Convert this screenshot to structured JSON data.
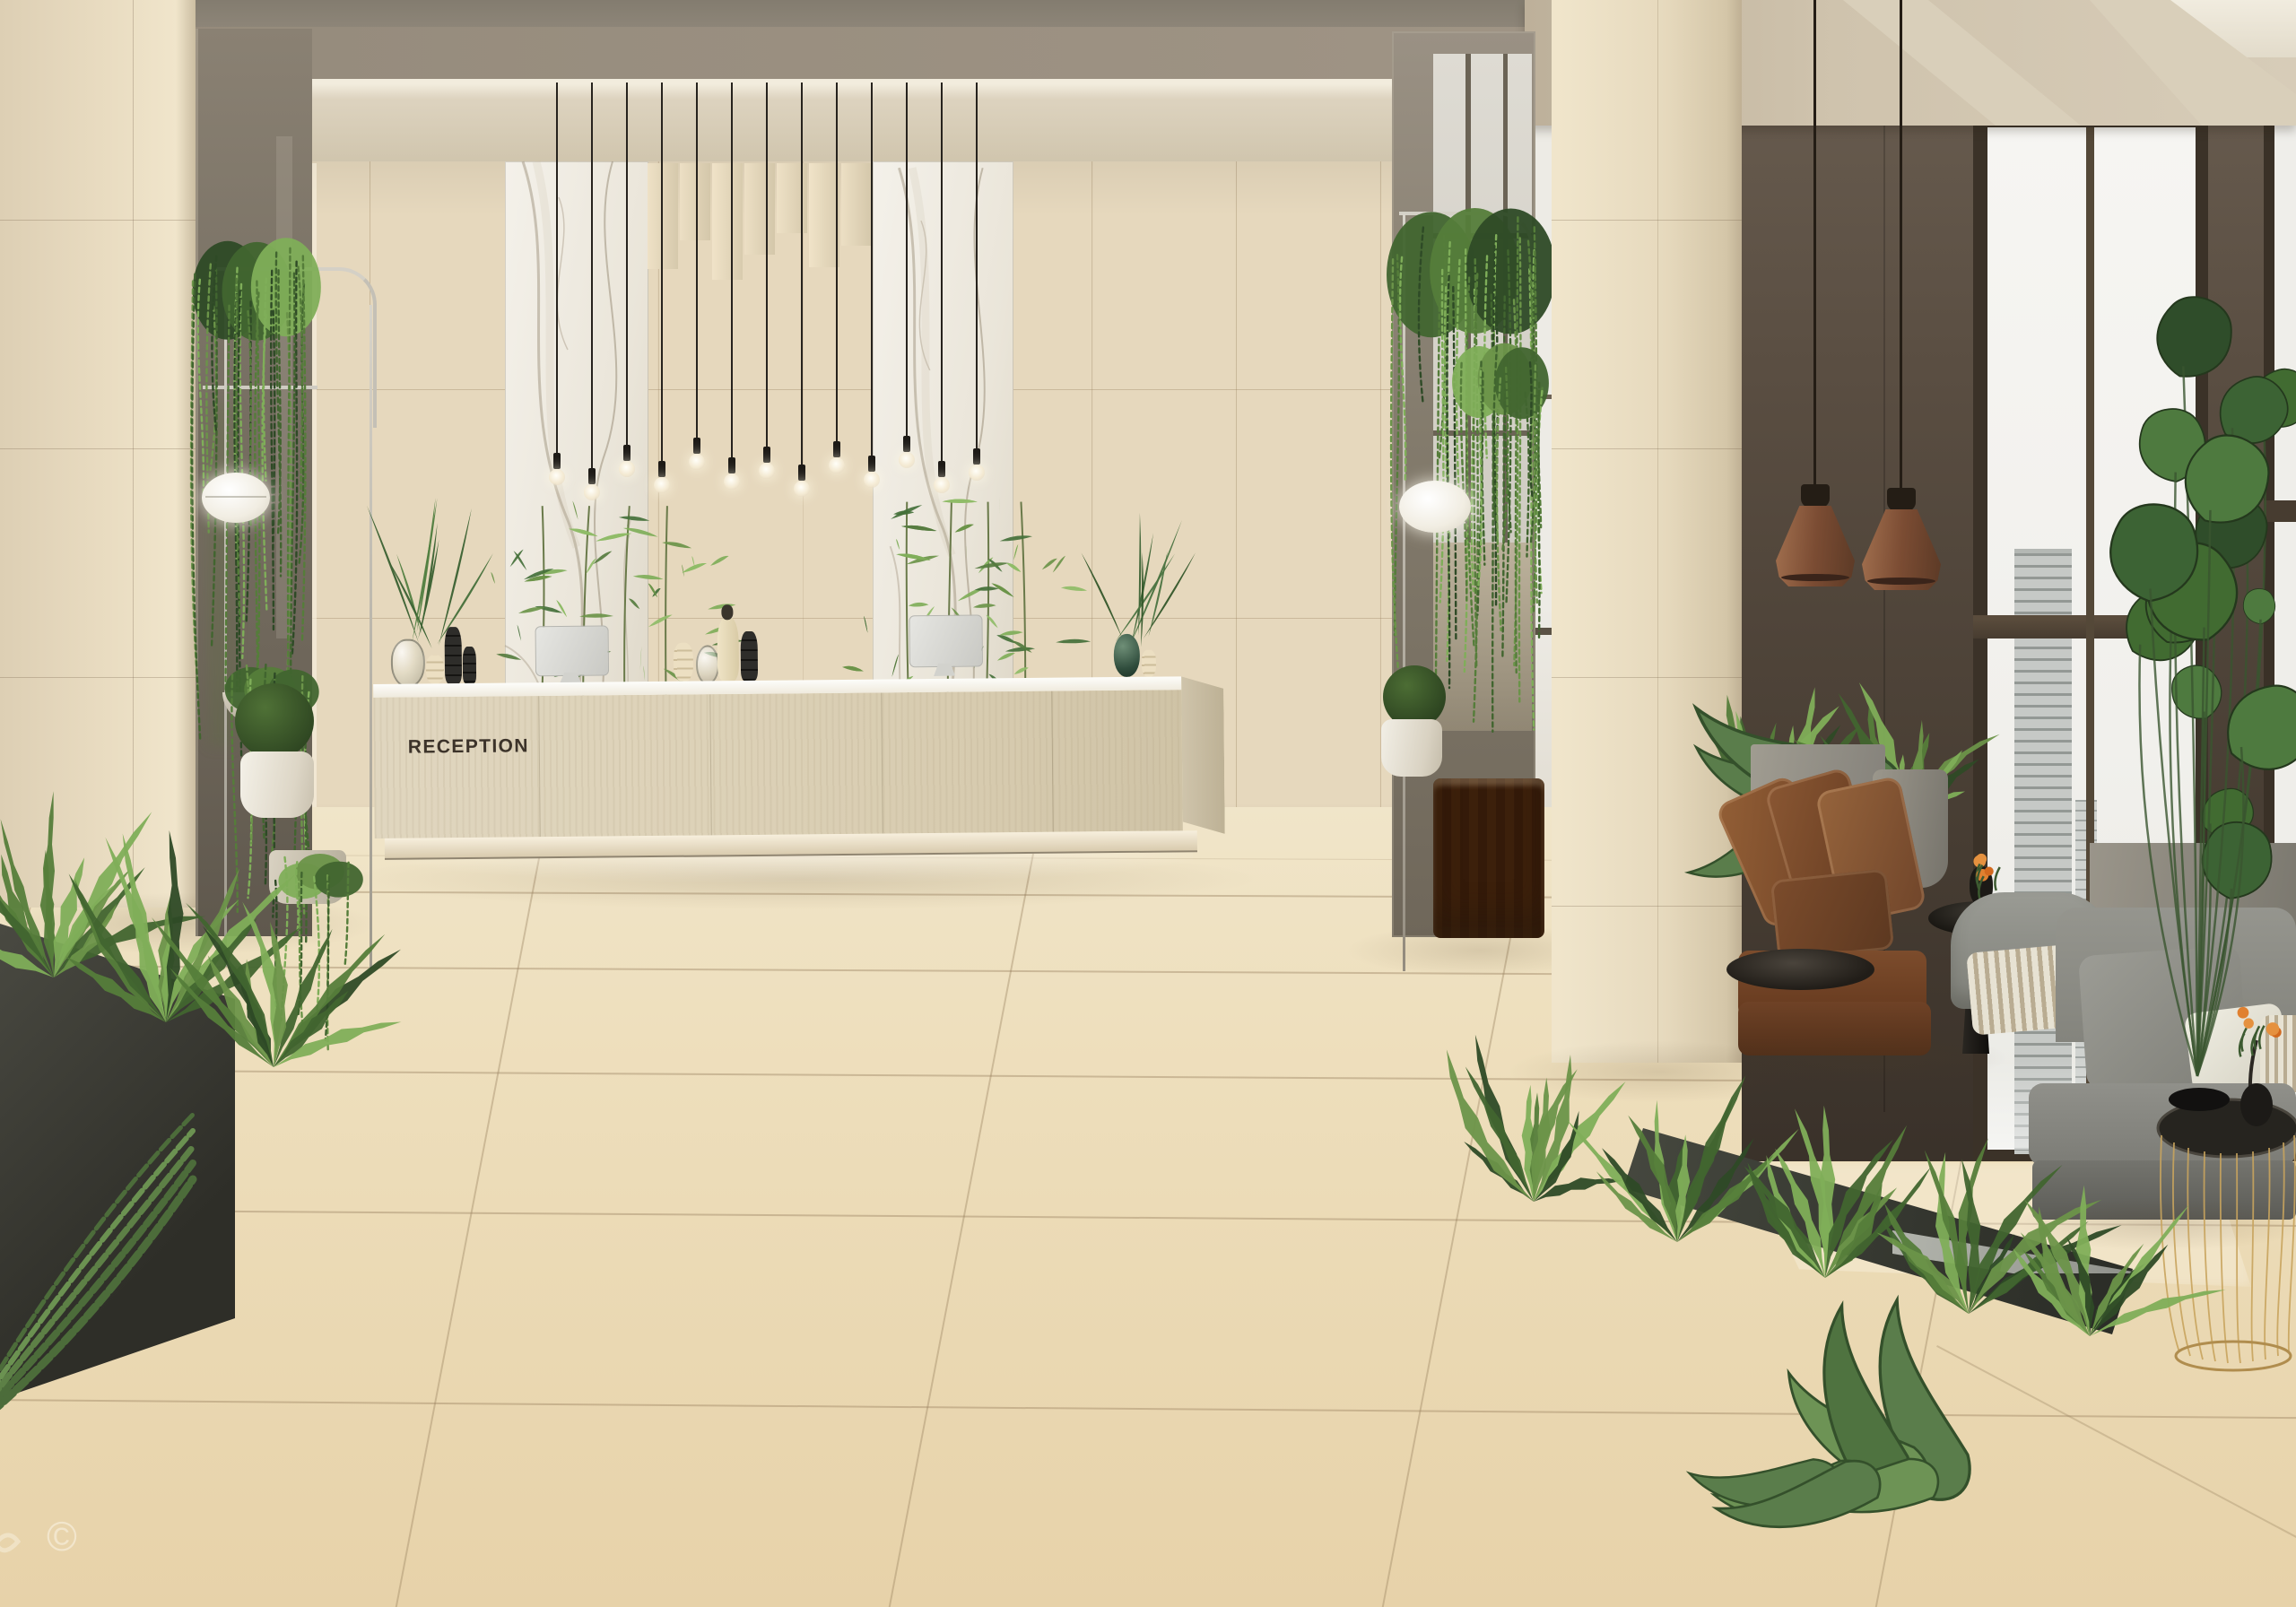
{
  "desk": {
    "sign_label": "RECEPTION"
  },
  "watermark": {
    "symbol": "©"
  },
  "palette": {
    "floor": "#ecdcb8",
    "wall_tile": "#e6d8bd",
    "marble": "#f2efe7",
    "ceiling_recess": "#998e7e",
    "beam": "#d9cfbb",
    "dark_wall": "#4e4336",
    "window_sky": "#f3f2ee",
    "desk_front": "#ddd3ba",
    "desk_top": "#fbfaf6",
    "plant_green": "#567c3f",
    "leather": "#82512f",
    "sofa_gray": "#8d8d86",
    "copper": "#7d4f36",
    "metal_chrome": "#cfcbc2"
  }
}
